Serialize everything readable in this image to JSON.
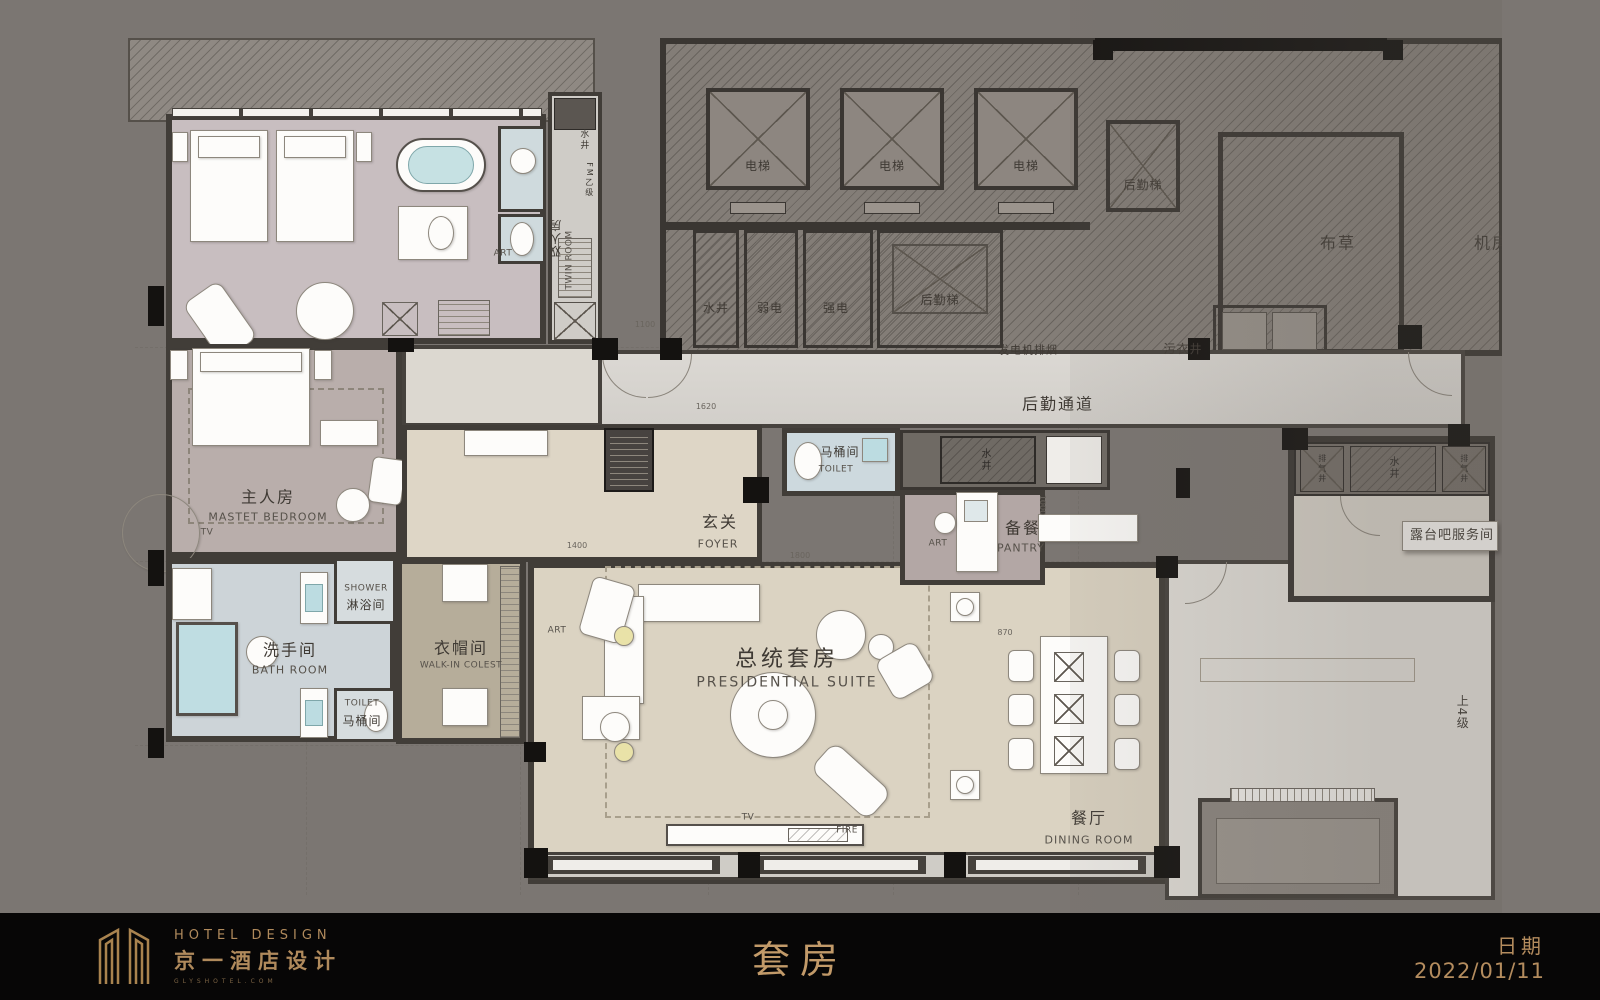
{
  "footer": {
    "brand_en": "HOTEL DESIGN",
    "brand_zh": "京一酒店设计",
    "brand_site": "GLYSHOTEL.COM",
    "sheet_title": "套房",
    "date_label": "日期",
    "date_value": "2022/01/11"
  },
  "rooms": {
    "twin": {
      "zh": "双人房",
      "en": "TWIN ROOM"
    },
    "master": {
      "zh": "主人房",
      "en": "MASTET BEDROOM",
      "tv": "TV"
    },
    "bath": {
      "zh": "洗手间",
      "en": "BATH ROOM"
    },
    "shower": {
      "zh": "淋浴间",
      "en": "SHOWER"
    },
    "toilet_master": {
      "zh": "马桶间",
      "en": "TOILET"
    },
    "closet": {
      "zh": "衣帽间",
      "en": "WALK-IN COLEST"
    },
    "foyer": {
      "zh": "玄关",
      "en": "FOYER"
    },
    "toilet_guest": {
      "zh": "马桶间",
      "en": "TOILET"
    },
    "pantry": {
      "zh": "备餐",
      "en": "PANTRY"
    },
    "suite": {
      "zh": "总统套房",
      "en": "PRESIDENTIAL SUITE"
    },
    "dining": {
      "zh": "餐厅",
      "en": "DINING ROOM"
    },
    "corridor": "后勤通道",
    "terrace_bar": "露台吧服务间",
    "steps": "上4级"
  },
  "core": {
    "elevator": "电梯",
    "service_lift": "后勤梯",
    "water_shaft": "水井",
    "exhaust_shaft": "排气井",
    "weak_power": "弱电",
    "strong_power": "强电",
    "generator_vent": "发电机排烟",
    "linen": "布草",
    "machine_room": "机房",
    "soiled_linen": "污衣井",
    "fire_door": "FM乙级"
  },
  "annotations": {
    "art": "ART",
    "tv": "TV",
    "fire": "FIRE",
    "dims": {
      "d1100": "1100",
      "d1620": "1620",
      "d1400": "1400",
      "d1800": "1800",
      "d870": "870",
      "d1000": "1000"
    }
  }
}
